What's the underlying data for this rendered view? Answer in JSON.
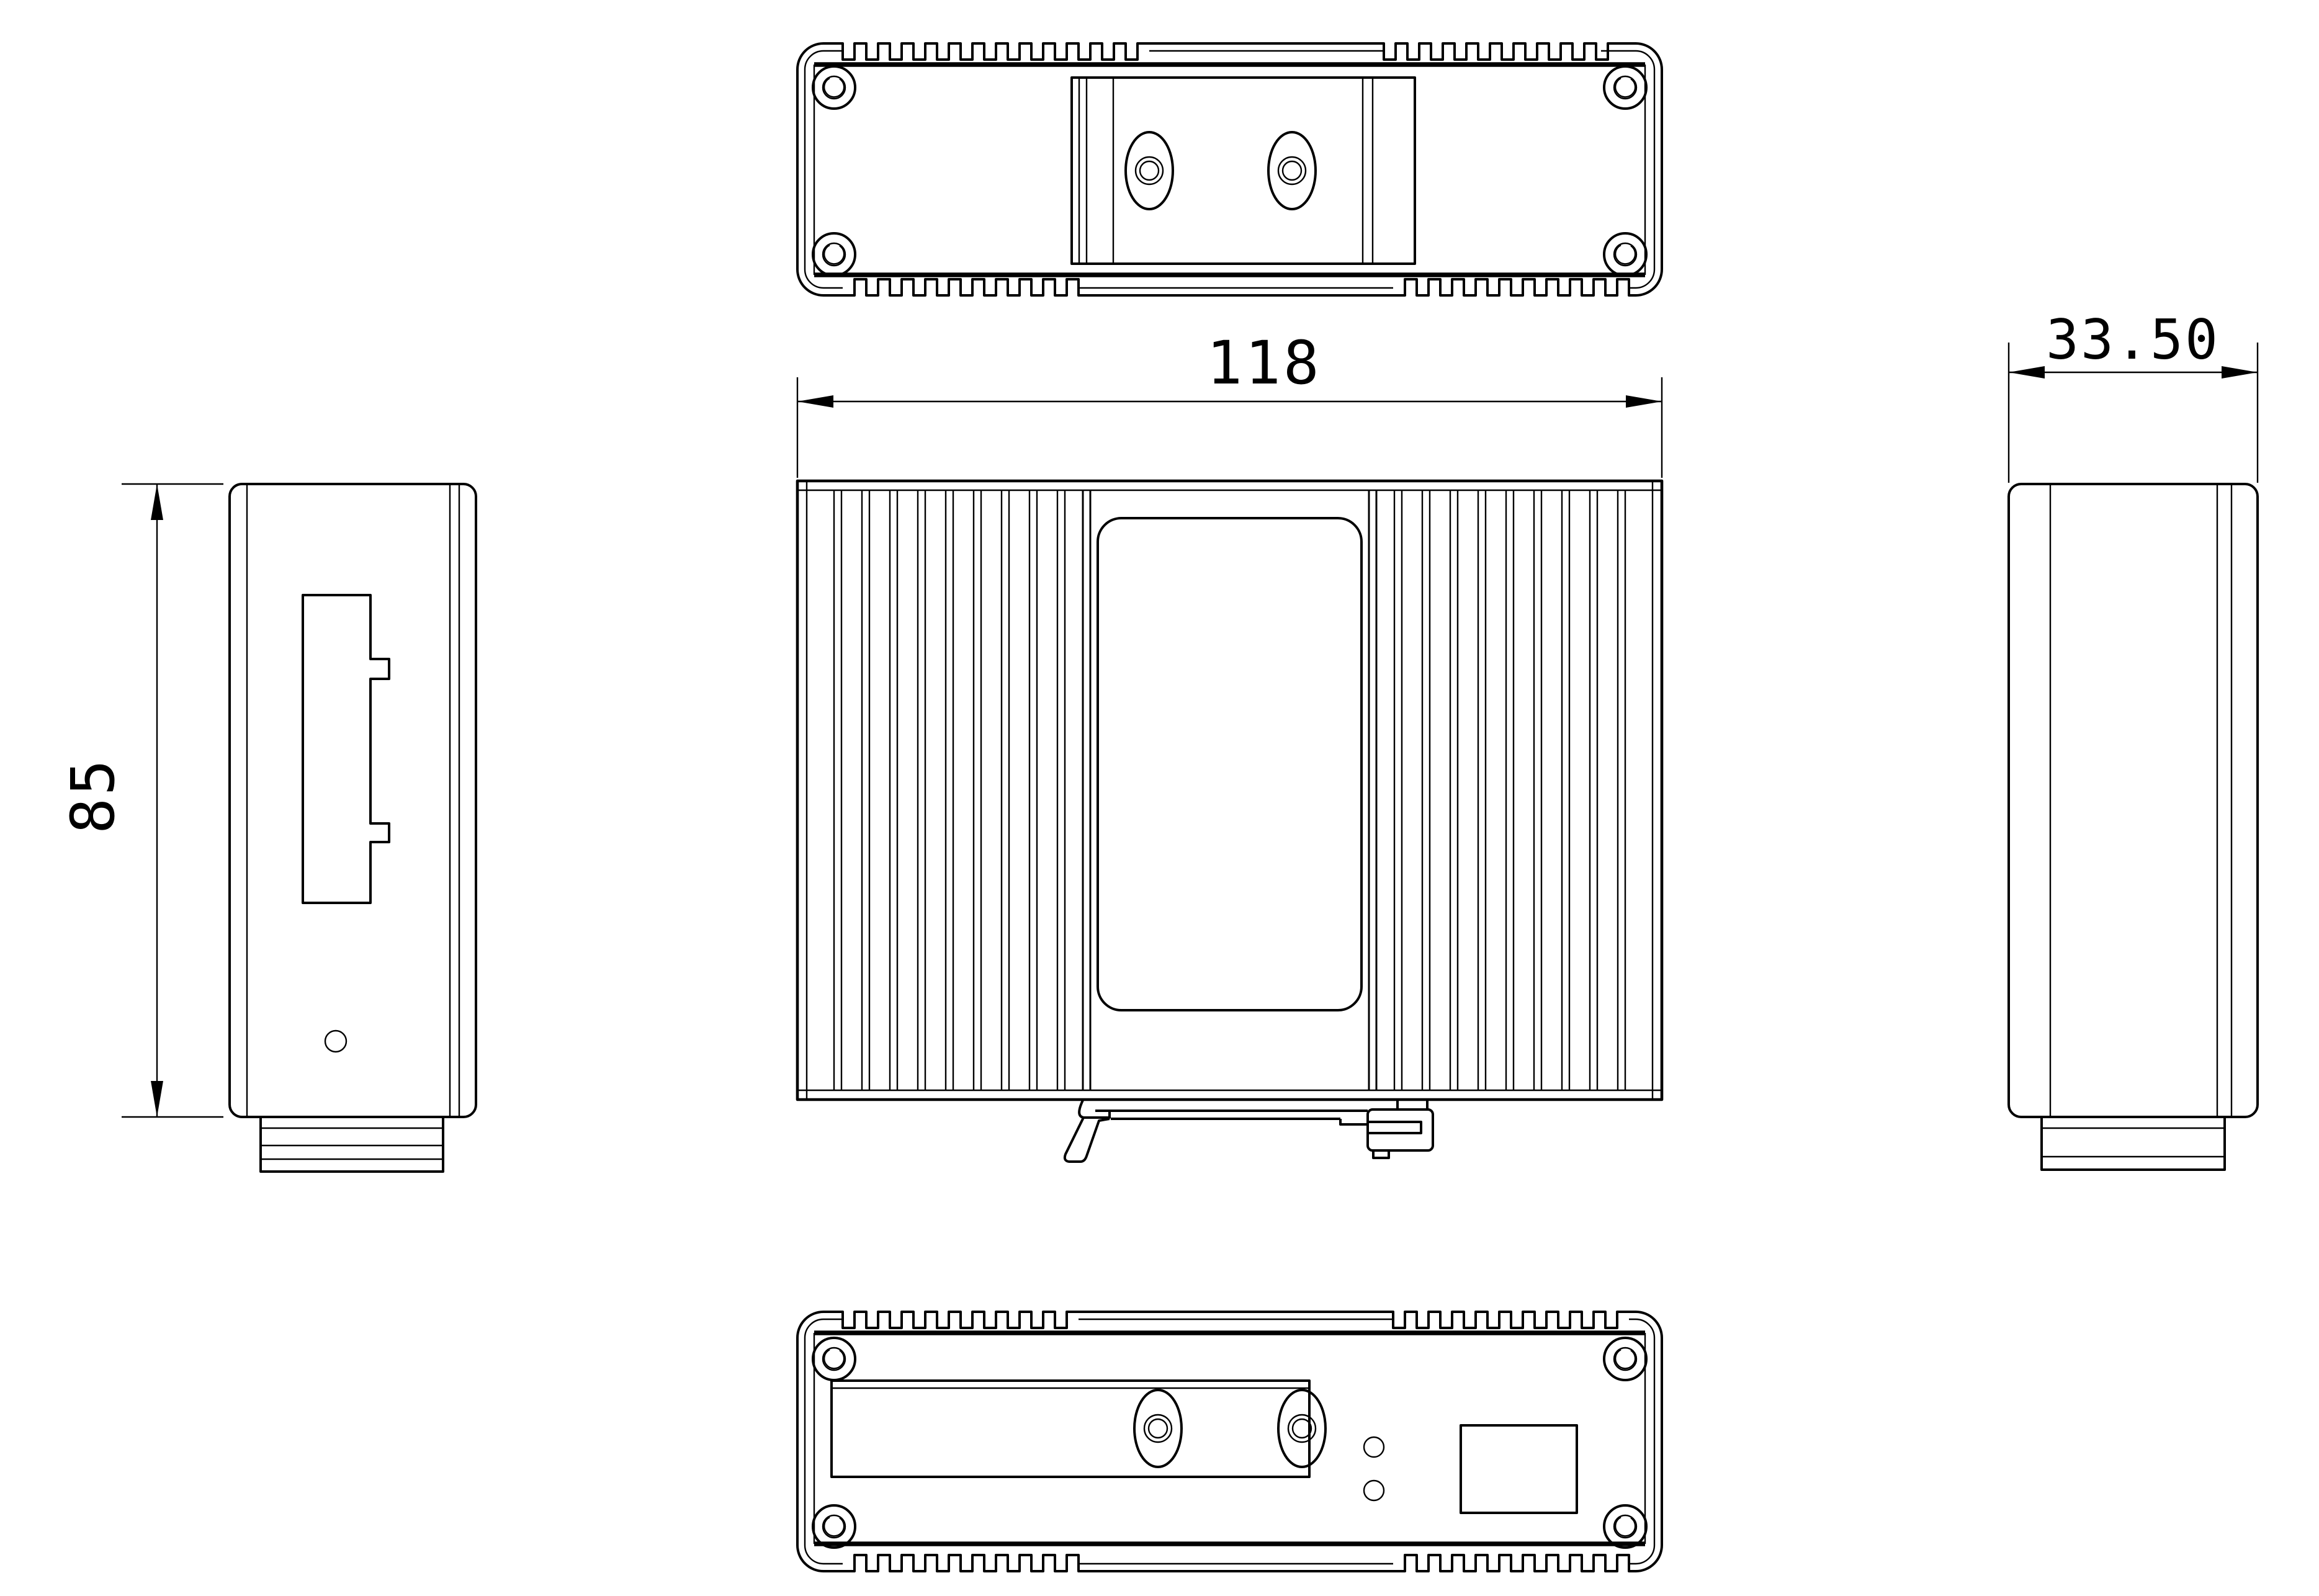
{
  "sheet": {
    "background": "#ffffff",
    "line_color": "#000000",
    "type": "orthographic engineering drawing",
    "subject": "DIN-rail mounted industrial enclosure"
  },
  "views": {
    "top": "top-view",
    "front": "front-view",
    "left_side": "left-side-view",
    "right_side": "right-side-view",
    "bottom": "bottom-view"
  },
  "dimensions": {
    "width": {
      "label": "118"
    },
    "depth": {
      "label": "33.50"
    },
    "height": {
      "label": "85"
    }
  }
}
